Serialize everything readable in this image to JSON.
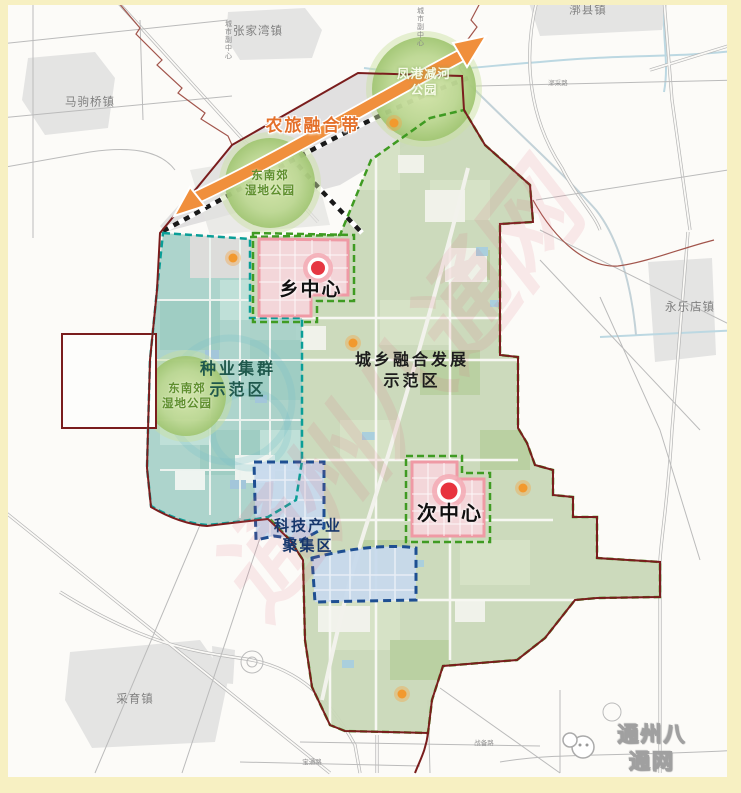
{
  "frame": {
    "border_color": "#f7f0c2"
  },
  "watermark": {
    "site_name": "通州八通网",
    "faint_text": "通州八通网"
  },
  "towns": [
    {
      "name": "张家湾镇"
    },
    {
      "name": "漷县镇"
    },
    {
      "name": "马驹桥镇"
    },
    {
      "name": "永乐店镇"
    },
    {
      "name": "采育镇"
    }
  ],
  "zones": {
    "seed_industry": {
      "label": "种业集群\n示范区",
      "fill": "#a9d2c9",
      "border": "#0a9e97"
    },
    "urban_rural": {
      "label": "城乡融合发展\n示范区",
      "fill": "#c9d8b8",
      "border": "#3f9b22"
    },
    "tech_industry": {
      "label": "科技产业\n聚集区",
      "fill": "#c7d9ec",
      "border": "#1e4f92"
    }
  },
  "centers": {
    "township": {
      "label": "乡中心",
      "marker_color": "#e63742"
    },
    "sub": {
      "label": "次中心",
      "marker_color": "#e8333e"
    }
  },
  "parks": [
    {
      "label": "东南郊\n湿地公园"
    },
    {
      "label": "东南郊\n湿地公园"
    },
    {
      "label": "凤港减河\n公园"
    }
  ],
  "corridor": {
    "label": "农旅融合带",
    "color": "#ee8a3c"
  },
  "roads": [
    {
      "label": "漷采路"
    },
    {
      "label": "战备路"
    },
    {
      "label": "宝通路"
    }
  ],
  "direction_markers": [
    {
      "label": "城市副中心"
    },
    {
      "label": "城市副中心"
    }
  ]
}
